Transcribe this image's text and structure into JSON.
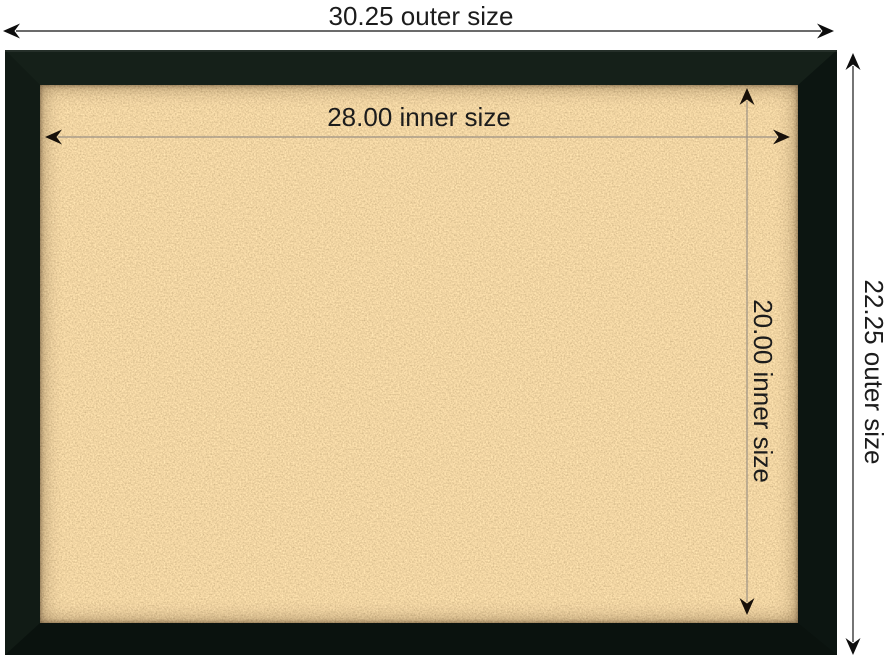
{
  "scene": {
    "description": "Framed cork board product dimension diagram",
    "background_color": "#ffffff",
    "text_color": "#1c1c1c"
  },
  "board": {
    "frame_color": "#0e1813",
    "cork_color": "#d2a05f",
    "frame_style": "black mitered frame",
    "surface": "cork"
  },
  "annotation_style": {
    "arrowhead": "stealth-chevron-double-arrow",
    "outer_line_color": "#3a3a3a",
    "inner_line_color": "#9b9184"
  },
  "dimensions": {
    "outer_width": {
      "label": "30.25 outer size",
      "value": 30.25
    },
    "outer_height": {
      "label": "22.25 outer size",
      "value": 22.25
    },
    "inner_width": {
      "label": "28.00 inner size",
      "value": 28.0
    },
    "inner_height": {
      "label": "20.00 inner size",
      "value": 20.0
    }
  }
}
